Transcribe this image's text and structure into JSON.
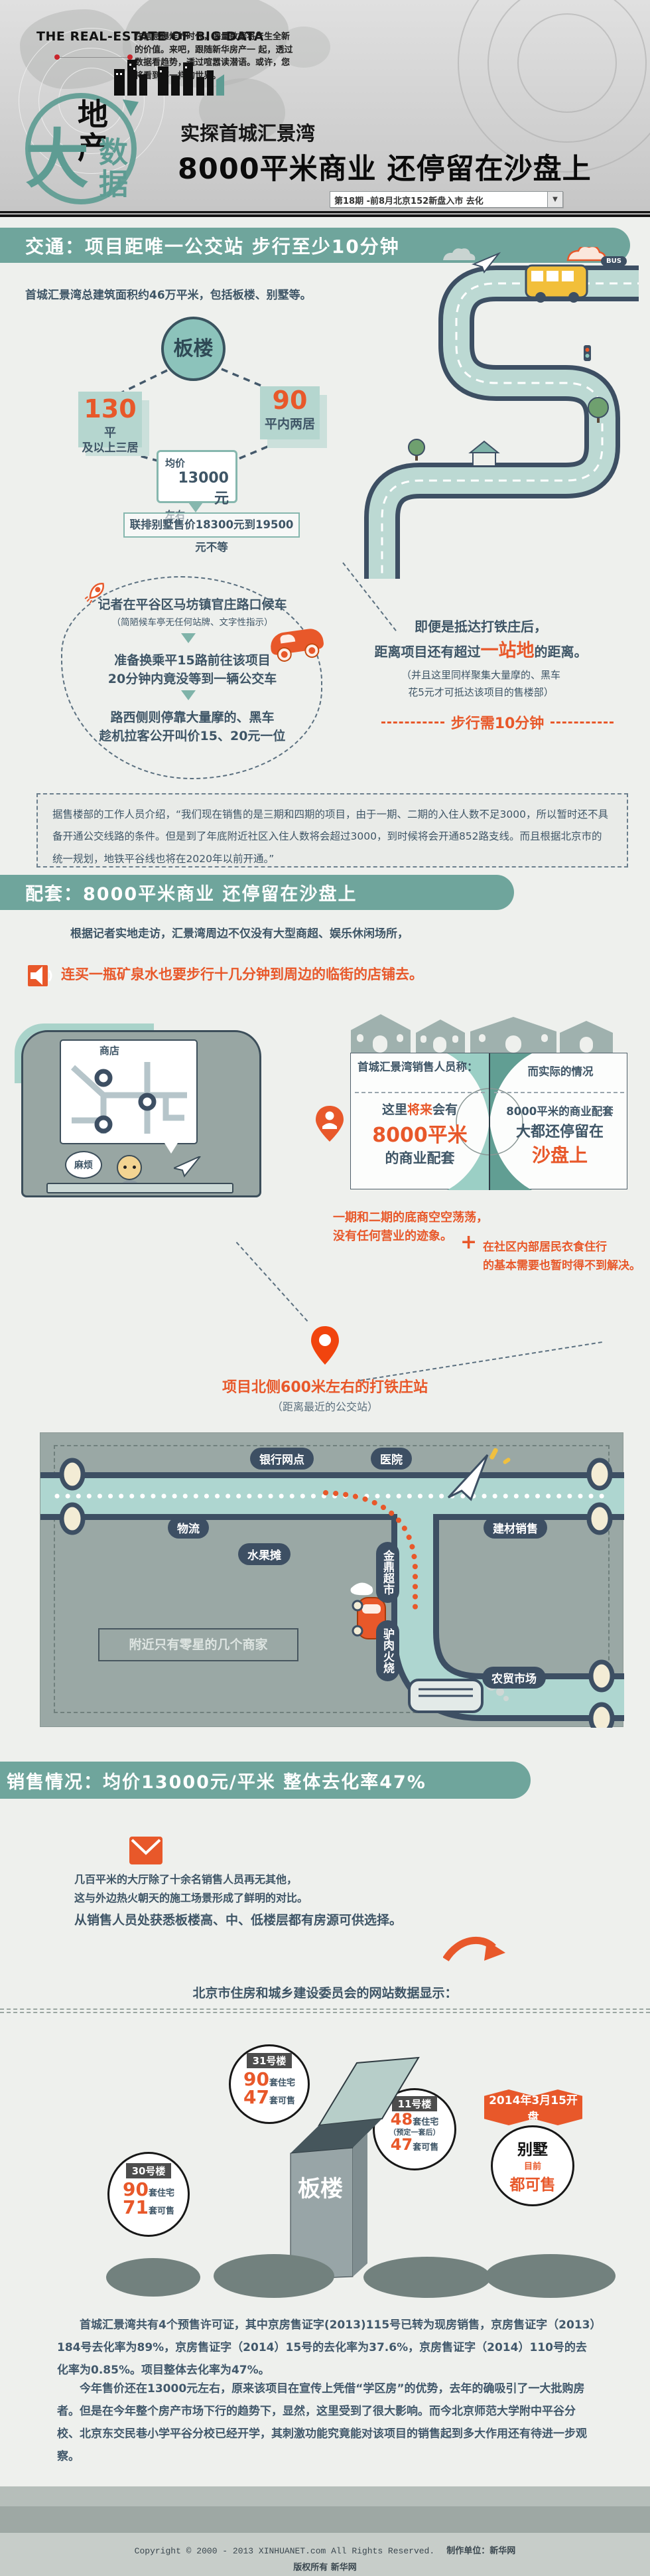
{
  "colors": {
    "teal": "#6fa59c",
    "orange": "#e8582a",
    "navy": "#3e5566",
    "map_bg": "#9aa8a5",
    "road": "#bcd9d3"
  },
  "header": {
    "brand": "THE REAL-ESTATE OF BIG DATA",
    "intro_l1": "在信息爆炸的时代，海量数据将产生全新的价值。来吧，跟随新华房产一",
    "intro_l2": "起，透过数据看趋势，透过喧嚣读潜语。或许，您将看到不一样的世界。",
    "logo_black": "地产",
    "logo_big": "大",
    "logo_teal": "数据",
    "subtitle": "实探首城汇景湾",
    "title": "8000平米商业 还停留在沙盘上",
    "issue_label": "第18期 -前8月北京152新盘入市 去化",
    "dropdown_arrow": "▼"
  },
  "traffic": {
    "heading": "交通：项目距唯一公交站 步行至少10分钟",
    "intro": "首城汇景湾总建筑面积约46万平米，包括板楼、别墅等。",
    "bus_sign": "BUS",
    "circle": "板楼",
    "unit_a_num": "130",
    "unit_a_unit": "平",
    "unit_a_sub": "及以上三居",
    "unit_b_num": "90",
    "unit_b_sub": "平内两居",
    "price_l1": "均价",
    "price_l2": "13000元",
    "price_l3": "左右",
    "villa_note": "联排别墅售价18300元到19500元不等",
    "step1": "记者在平谷区马坊镇官庄路口候车",
    "step1_sub": "（简陋候车亭无任何站牌、文字性指示）",
    "step2_l1": "准备换乘平15路前往该项目",
    "step2_l2": "20分钟内竟没等到一辆公交车",
    "step3_l1": "路西侧则停靠大量摩的、黑车",
    "step3_l2": "趁机拉客公开叫价15、20元一位",
    "arrive_l1": "即便是抵达打铁庄后，",
    "arrive_pre": "距离项目还有超过",
    "arrive_hl": "一站地",
    "arrive_post": "的距离。",
    "arrive_note_l1": "（并且这里同样聚集大量摩的、黑车",
    "arrive_note_l2": "花5元才可抵达该项目的售楼部）",
    "walk_note": "步行需10分钟",
    "quote": "据售楼部的工作人员介绍，“我们现在销售的是三期和四期的项目，由于一期、二期的入住人数不足3000，所以暂时还不具备开通公交线路的条件。但是到了年底附近社区入住人数将会超过3000，到时候将会开通852路支线。而且根据北京市的统一规划，地铁平谷线也将在2020年以前开通。”"
  },
  "amenities": {
    "heading": "配套：8000平米商业 还停留在沙盘上",
    "intro": "根据记者实地走访，汇景湾周边不仅没有大型商超、娱乐休闲场所，",
    "highlight": "连买一瓶矿泉水也要步行十几分钟到周边的临街的店铺去。",
    "shop_label": "商店",
    "trouble": "麻烦",
    "cmp_left_title": "首城汇景湾销售人员称：",
    "cmp_left_pre": "这里",
    "cmp_left_hl": "将来",
    "cmp_left_post": "会有",
    "cmp_left_big": "8000平米",
    "cmp_left_tail": "的商业配套",
    "cmp_right_title": "而实际的情况",
    "cmp_right_l1": "8000平米的商业配套",
    "cmp_right_l2": "大都还停留在",
    "cmp_right_hl": "沙盘上",
    "empty_l1": "一期和二期的底商空空荡荡，",
    "empty_l2": "没有任何营业的迹象。",
    "plus_sign": "+",
    "plus_l1": "在社区内部居民衣食住行",
    "plus_l2": "的基本需要也暂时得不到解决。",
    "station_title": "项目北侧600米左右的打铁庄站",
    "station_sub": "（距离最近的公交站）",
    "map": {
      "bank": "银行网点",
      "hospital": "医院",
      "logistics": "物流",
      "materials": "建材销售",
      "fruit": "水果摊",
      "supermarket": "金鼎超市",
      "donkey": "驴肉火烧",
      "farmers": "农贸市场",
      "note": "附近只有零星的几个商家"
    }
  },
  "sales": {
    "heading": "销售情况：均价13000元/平米 整体去化率47%",
    "hall_l1": "几百平米的大厅除了十余名销售人员再无其他，",
    "hall_l2": "这与外边热火朝天的施工场景形成了鲜明的对比。",
    "hall_l3": "从销售人员处获悉板楼高、中、低楼层都有房源可供选择。",
    "source": "北京市住房和城乡建设委员会的网站数据显示：",
    "towers": [
      {
        "name": "31号楼",
        "n1": "90",
        "u1": "套住宅",
        "n2": "47",
        "u2": "套可售"
      },
      {
        "name": "30号楼",
        "n1": "90",
        "u1": "套住宅",
        "n2": "71",
        "u2": "套可售"
      },
      {
        "name": "11号楼",
        "n1": "48",
        "u1": "套住宅",
        "note": "（预定一套后）",
        "n2": "47",
        "u2": "套可售"
      }
    ],
    "flag": "2014年3月15开盘",
    "villa_title": "别墅",
    "villa_sub": "目前",
    "villa_hl": "都可售",
    "building": "板楼",
    "para1": "首城汇景湾共有4个预售许可证，其中京房售证字(2013)115号已转为现房销售，京房售证字（2013）184号去化率为89%，京房售证字（2014）15号的去化率为37.6%，京房售证字（2014）110号的去化率为0.85%。项目整体去化率为47%。",
    "para2": "今年售价还在13000元左右，原来该项目在宣传上凭借“学区房”的优势，去年的确吸引了一大批购房者。但是在今年整个房产市场下行的趋势下，显然，这里受到了很大影响。而今北京师范大学附中平谷分校、北京东交民巷小学平谷分校已经开学，其刺激功能究竟能对该项目的销售起到多大作用还有待进一步观察。"
  },
  "footer": {
    "copyright": "Copyright © 2000 - 2013 XINHUANET.com  All Rights Reserved.",
    "producer": "制作单位：新华网",
    "rights": "版权所有 新华网"
  }
}
